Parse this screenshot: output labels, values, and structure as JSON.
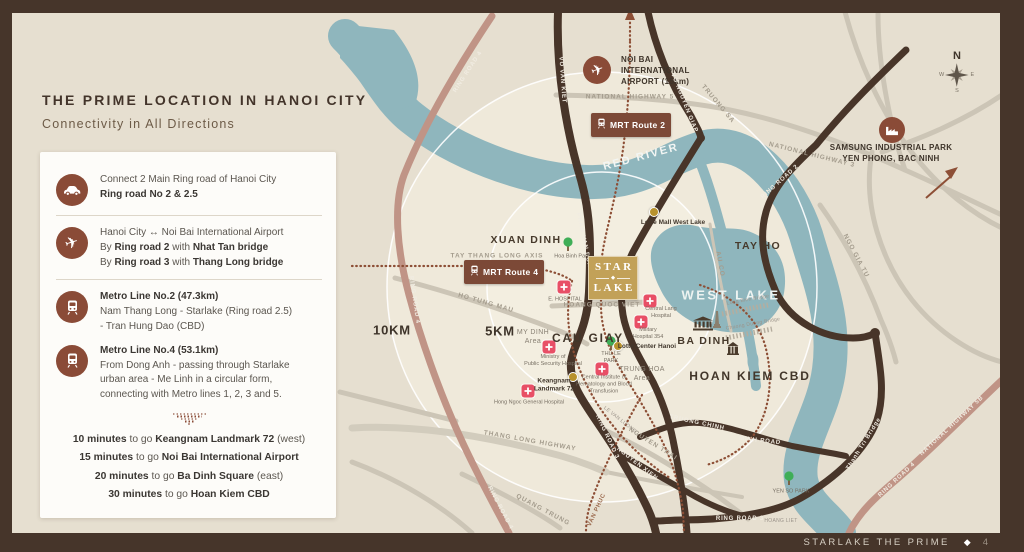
{
  "header": {
    "title": "THE PRIME LOCATION IN HANOI CITY",
    "subtitle": "Connectivity in All Directions"
  },
  "panel": {
    "items": [
      {
        "icon": "car-icon",
        "sep": true,
        "lines": [
          [
            {
              "t": "Connect 2 Main Ring road of Hanoi City"
            }
          ],
          [
            {
              "t": "Ring road No 2 & 2.5",
              "b": 1
            }
          ]
        ]
      },
      {
        "icon": "plane-icon",
        "sep": true,
        "lines": [
          [
            {
              "t": "Hanoi City ↔ Noi Bai International Airport"
            }
          ],
          [
            {
              "t": "By "
            },
            {
              "t": "Ring road 2",
              "b": 1
            },
            {
              "t": " with "
            },
            {
              "t": "Nhat Tan bridge",
              "b": 1
            }
          ],
          [
            {
              "t": "By "
            },
            {
              "t": "Ring road 3",
              "b": 1
            },
            {
              "t": " with "
            },
            {
              "t": "Thang Long bridge",
              "b": 1
            }
          ]
        ]
      },
      {
        "icon": "train-icon",
        "sep": false,
        "lines": [
          [
            {
              "t": "Metro Line No.2 (47.3km)",
              "b": 1
            }
          ],
          [
            {
              "t": "Nam Thang Long - Starlake (Ring road 2.5)"
            }
          ],
          [
            {
              "t": "-  Tran Hung Dao (CBD)"
            }
          ]
        ]
      },
      {
        "icon": "train-icon",
        "sep": false,
        "lines": [
          [
            {
              "t": "Metro Line No.4 (53.1km)",
              "b": 1
            }
          ],
          [
            {
              "t": "From Dong Anh - passing through Starlake"
            }
          ],
          [
            {
              "t": "urban area - Me Linh in a circular form,"
            }
          ],
          [
            {
              "t": "connecting with Metro lines 1, 2, 3 and 5."
            }
          ]
        ]
      }
    ],
    "times": [
      [
        {
          "t": "10 minutes",
          "b": 1
        },
        {
          "t": " to go "
        },
        {
          "t": "Keangnam Landmark 72",
          "b": 1
        },
        {
          "t": " (west)"
        }
      ],
      [
        {
          "t": "15 minutes",
          "b": 1
        },
        {
          "t": " to go "
        },
        {
          "t": "Noi Bai International Airport",
          "b": 1
        }
      ],
      [
        {
          "t": "20 minutes",
          "b": 1
        },
        {
          "t": " to go "
        },
        {
          "t": "Ba Dinh Square",
          "b": 1
        },
        {
          "t": " (east)"
        }
      ],
      [
        {
          "t": "30 minutes",
          "b": 1
        },
        {
          "t": " to go "
        },
        {
          "t": "Hoan Kiem CBD",
          "b": 1
        }
      ]
    ]
  },
  "map": {
    "starlake": {
      "line1": "STAR",
      "line2": "LAKE"
    },
    "compass": {
      "n": "N",
      "e": "E",
      "s": "S",
      "w": "W"
    },
    "badges": [
      {
        "label": "MRT Route 2",
        "x": 591,
        "y": 113
      },
      {
        "label": "MRT Route 4",
        "x": 464,
        "y": 260
      }
    ],
    "labels": [
      {
        "t": "NOI BAI\nINTERNATIONAL\nAIRPORT (15km)",
        "x": 621,
        "y": 71,
        "cls": "poi-big",
        "align": "left"
      },
      {
        "t": "NATIONAL HIGHWAY 5",
        "x": 630,
        "y": 97,
        "cls": "roadgray"
      },
      {
        "t": "SAMSUNG INDUSTRIAL PARK\nYEN PHONG, BAC NINH",
        "x": 891,
        "y": 153,
        "cls": "poi-big"
      },
      {
        "t": "NATIONAL HIGHWAY 3",
        "x": 812,
        "y": 155,
        "cls": "roadgray",
        "rot": 14
      },
      {
        "t": "RED RIVER",
        "x": 641,
        "y": 157,
        "cls": "river",
        "rot": -15
      },
      {
        "t": "RING ROAD 4",
        "x": 468,
        "y": 72,
        "cls": "roadwhite",
        "rot": -57
      },
      {
        "t": "RING ROAD 4",
        "x": 414,
        "y": 300,
        "cls": "roadwhite",
        "rot": 82
      },
      {
        "t": "RING ROAD 4",
        "x": 500,
        "y": 508,
        "cls": "roadwhite",
        "rot": 62
      },
      {
        "t": "RING ROAD 2",
        "x": 780,
        "y": 182,
        "cls": "roadwhite",
        "rot": -42
      },
      {
        "t": "VO NGUYEN GIAP",
        "x": 684,
        "y": 103,
        "cls": "roadwhite",
        "rot": 68
      },
      {
        "t": "VO VAN KIET",
        "x": 562,
        "y": 80,
        "cls": "roadwhite",
        "rot": 86
      },
      {
        "t": "TRUONG SA",
        "x": 718,
        "y": 104,
        "cls": "roadgray",
        "rot": 50
      },
      {
        "t": "XUAN DINH",
        "x": 526,
        "y": 240,
        "cls": "area"
      },
      {
        "t": "TAY THANG LONG AXIS",
        "x": 497,
        "y": 256,
        "cls": "roadgray"
      },
      {
        "t": "TAY HO",
        "x": 758,
        "y": 246,
        "cls": "area"
      },
      {
        "t": "WEST LAKE",
        "x": 731,
        "y": 295,
        "cls": "lake"
      },
      {
        "t": "AU CO",
        "x": 720,
        "y": 264,
        "cls": "roadgray",
        "rot": 80
      },
      {
        "t": "NGO GIA TU",
        "x": 856,
        "y": 256,
        "cls": "roadgray",
        "rot": 62
      },
      {
        "t": "Lotte Mall West Lake",
        "x": 673,
        "y": 223,
        "cls": "poi-sm"
      },
      {
        "t": "PHAM VAN DONG",
        "x": 584,
        "y": 243,
        "cls": "roadwhite",
        "rot": 78
      },
      {
        "t": "VO CHI CONG",
        "x": 628,
        "y": 273,
        "cls": "roadwhite",
        "rot": 72
      },
      {
        "t": "Hoa Binh Park",
        "x": 572,
        "y": 257,
        "cls": "tiny"
      },
      {
        "t": "E. HOSPITAL",
        "x": 565,
        "y": 300,
        "cls": "tiny"
      },
      {
        "t": "HOANG QUOC VIET",
        "x": 602,
        "y": 305,
        "cls": "roadgray"
      },
      {
        "t": "10KM",
        "x": 392,
        "y": 330,
        "cls": "km"
      },
      {
        "t": "5KM",
        "x": 500,
        "y": 331,
        "cls": "km"
      },
      {
        "t": "HO TUNG MAU",
        "x": 486,
        "y": 303,
        "cls": "roadgray",
        "rot": 16
      },
      {
        "t": "MY DINH\nArea",
        "x": 533,
        "y": 337,
        "cls": "areasub"
      },
      {
        "t": "CAU GIAY",
        "x": 588,
        "y": 338,
        "cls": "arealg"
      },
      {
        "t": "Central Lang\nHospital",
        "x": 661,
        "y": 313,
        "cls": "tiny"
      },
      {
        "t": "Military\nHospital 354",
        "x": 648,
        "y": 334,
        "cls": "tiny"
      },
      {
        "t": "BA DINH",
        "x": 704,
        "y": 341,
        "cls": "area"
      },
      {
        "t": "Lotte Center Hanoi",
        "x": 647,
        "y": 347,
        "cls": "poi-sm"
      },
      {
        "t": "THU LE\nPARK",
        "x": 611,
        "y": 358,
        "cls": "tiny"
      },
      {
        "t": "TRUNG HOA\nArea",
        "x": 642,
        "y": 374,
        "cls": "areasub"
      },
      {
        "t": "HOAN KIEM CBD",
        "x": 750,
        "y": 376,
        "cls": "arealg"
      },
      {
        "t": "Ministry of\nPublic Security Hospital",
        "x": 553,
        "y": 361,
        "cls": "tiny"
      },
      {
        "t": "Central Institute of\nHematology and Blood\nTransfusion",
        "x": 604,
        "y": 385,
        "cls": "tiny"
      },
      {
        "t": "Keangnam\nLandmark 72",
        "x": 554,
        "y": 386,
        "cls": "poi-sm"
      },
      {
        "t": "Hong Ngoc General Hospital",
        "x": 529,
        "y": 403,
        "cls": "tiny"
      },
      {
        "t": "THANG LONG HIGHWAY",
        "x": 530,
        "y": 441,
        "cls": "roadgray",
        "rot": 10
      },
      {
        "t": "NGUYEN TRAI",
        "x": 653,
        "y": 444,
        "cls": "roadgray",
        "rot": 32
      },
      {
        "t": "LE VAN LUONG",
        "x": 620,
        "y": 420,
        "cls": "tinyroad",
        "rot": 38
      },
      {
        "t": "TRUONG CHINH",
        "x": 697,
        "y": 423,
        "cls": "roadwhite",
        "rot": 12
      },
      {
        "t": "MINH ROAD",
        "x": 760,
        "y": 441,
        "cls": "roadwhite",
        "rot": 6
      },
      {
        "t": "RING ROAD 3",
        "x": 607,
        "y": 437,
        "cls": "roadwhite",
        "rot": 65
      },
      {
        "t": "NGUYEN XIEN",
        "x": 637,
        "y": 464,
        "cls": "roadwhite",
        "rot": 38
      },
      {
        "t": "RING ROAD 3",
        "x": 740,
        "y": 519,
        "cls": "roadwhite"
      },
      {
        "t": "HOANG LIET",
        "x": 781,
        "y": 521,
        "cls": "tinyroad"
      },
      {
        "t": "QUANG TRUNG",
        "x": 543,
        "y": 510,
        "cls": "roadgray",
        "rot": 28
      },
      {
        "t": "VAN PHUC",
        "x": 597,
        "y": 510,
        "cls": "roadbrown",
        "rot": -65
      },
      {
        "t": "YEN SO PARK",
        "x": 791,
        "y": 492,
        "cls": "tiny"
      },
      {
        "t": "Thanh Tri Bridge",
        "x": 864,
        "y": 444,
        "cls": "roadwhite",
        "rot": -58
      },
      {
        "t": "NATIONAL HIGHWAY 5B",
        "x": 952,
        "y": 426,
        "cls": "roadwhite",
        "rot": -43
      },
      {
        "t": "RING ROAD 4",
        "x": 897,
        "y": 480,
        "cls": "roadwhite",
        "rot": -43
      },
      {
        "t": "Long Bien Bridge",
        "x": 748,
        "y": 300,
        "cls": "tinyroad",
        "rot": -10
      },
      {
        "t": "Chuong Duong Bridge",
        "x": 753,
        "y": 324,
        "cls": "tinyroad",
        "rot": -10
      }
    ],
    "pois": [
      {
        "type": "plane-circle",
        "x": 597,
        "y": 70
      },
      {
        "type": "factory-circle",
        "x": 892,
        "y": 130
      },
      {
        "type": "hospital",
        "x": 564,
        "y": 287
      },
      {
        "type": "hospital",
        "x": 650,
        "y": 301
      },
      {
        "type": "hospital",
        "x": 641,
        "y": 322
      },
      {
        "type": "hospital",
        "x": 549,
        "y": 347
      },
      {
        "type": "hospital",
        "x": 602,
        "y": 369
      },
      {
        "type": "hospital",
        "x": 528,
        "y": 391
      },
      {
        "type": "tree",
        "x": 568,
        "y": 247
      },
      {
        "type": "tree",
        "x": 611,
        "y": 346
      },
      {
        "type": "tree",
        "x": 789,
        "y": 481
      },
      {
        "type": "gold-dot",
        "x": 654,
        "y": 212
      },
      {
        "type": "gold-dot",
        "x": 618,
        "y": 346
      },
      {
        "type": "gold-dot",
        "x": 573,
        "y": 377
      },
      {
        "type": "bank",
        "x": 703,
        "y": 326
      },
      {
        "type": "monument",
        "x": 717,
        "y": 322
      },
      {
        "type": "temple",
        "x": 733,
        "y": 351
      }
    ]
  },
  "footer": {
    "brand": "STARLAKE THE PRIME",
    "icon": "◆",
    "page": "4"
  },
  "colors": {
    "accent": "#8a4b37",
    "badge": "#7c4937",
    "gold": "#c2a158",
    "river": "#8fb6bd",
    "road_dark": "#483529",
    "road_pink": "#c09486",
    "hospital": "#e84f66",
    "park": "#3fae57",
    "frame": "#46352a",
    "title": "#43342a"
  }
}
